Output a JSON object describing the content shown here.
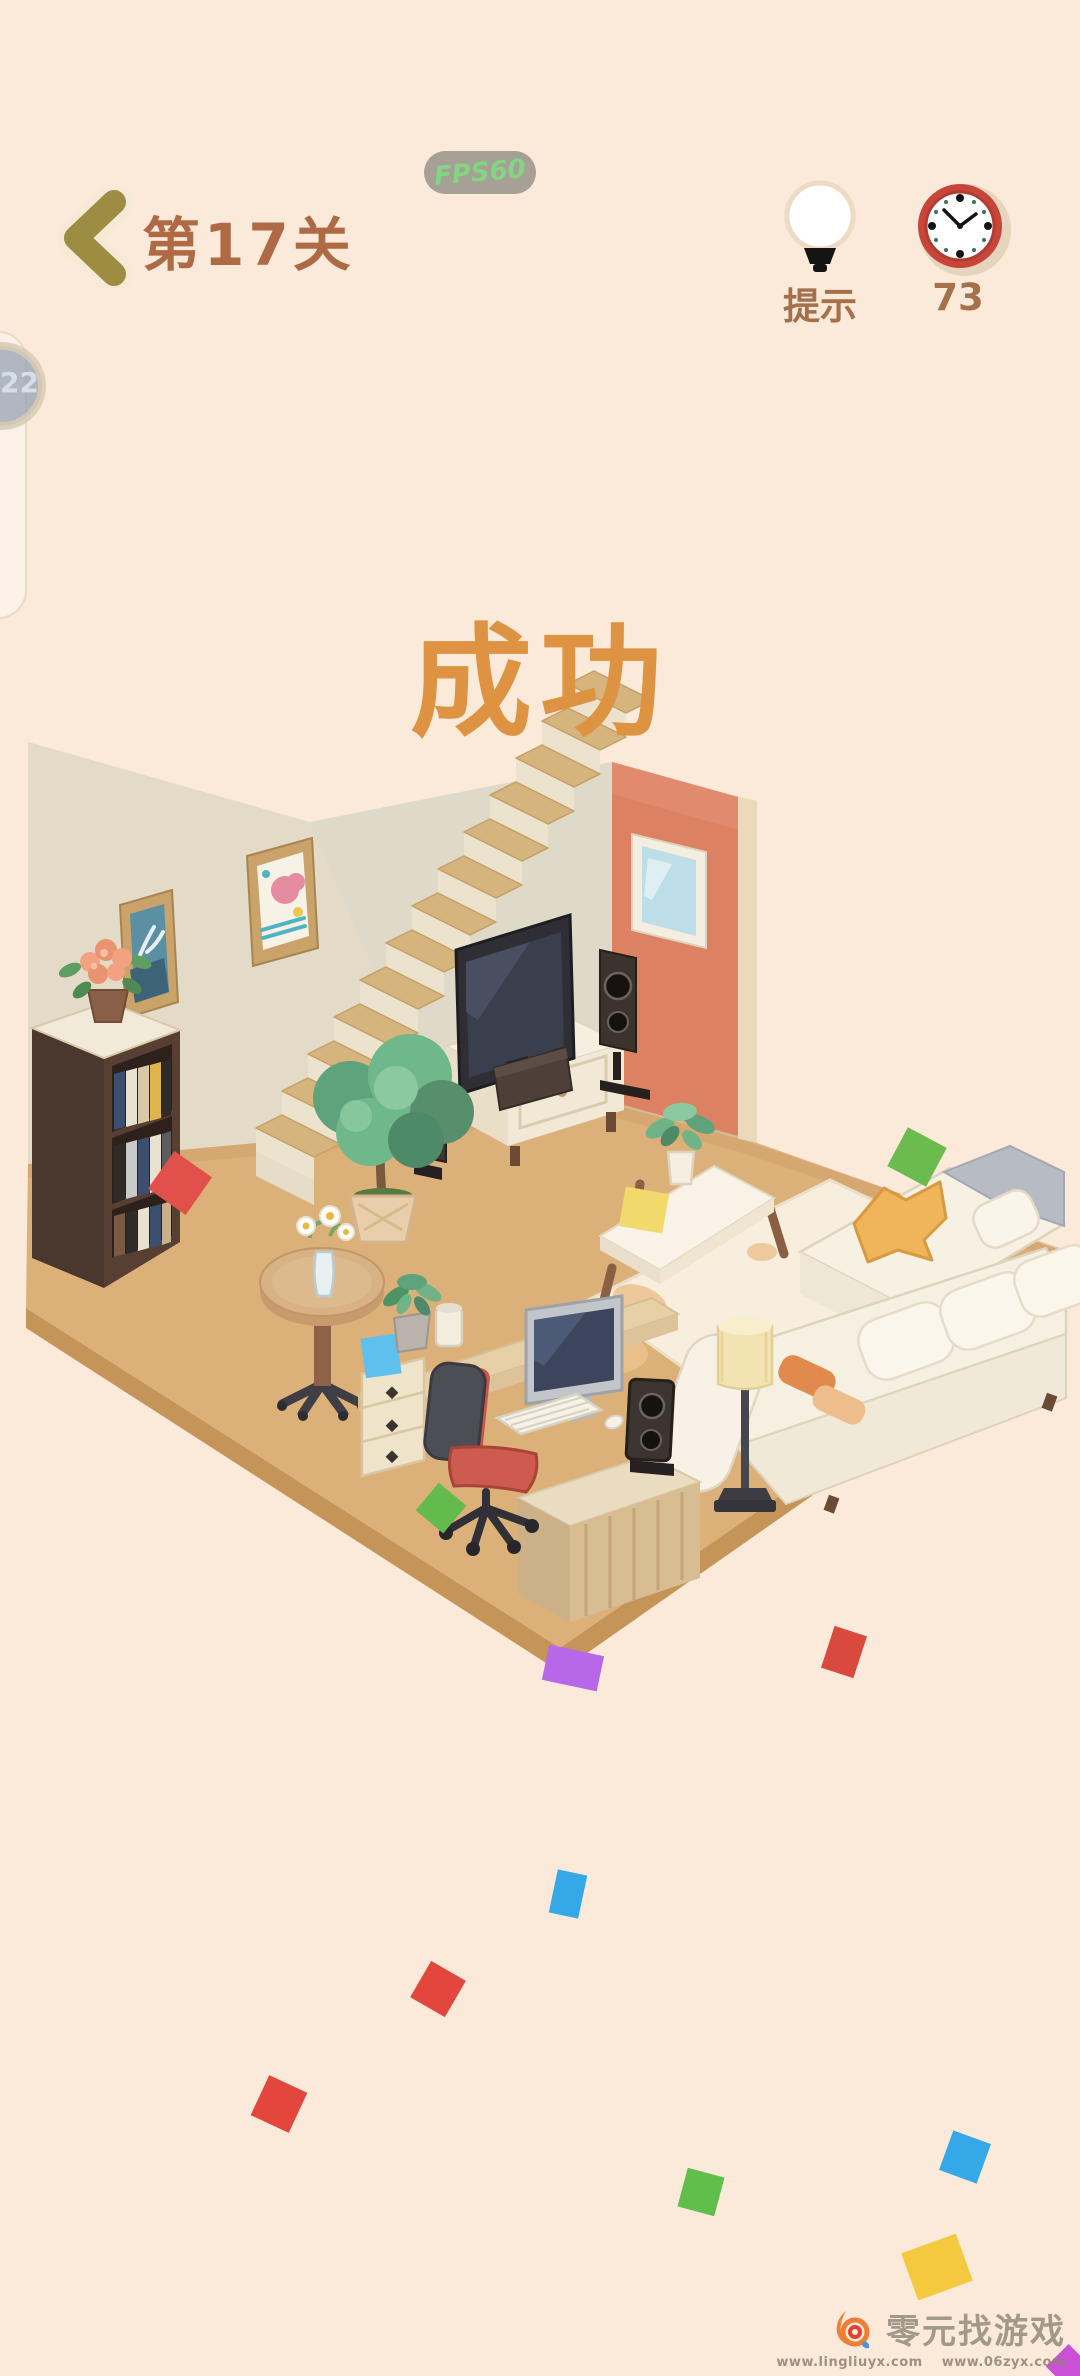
{
  "header": {
    "level_label": "第17关",
    "fps_badge": "FPS60",
    "hint_label": "提示",
    "timer_value": "73"
  },
  "floating_widget": {
    "badge_value": "22"
  },
  "overlay": {
    "success_text": "成功"
  },
  "watermark": {
    "site_name": "零元找游戏",
    "url_primary": "www.lingliuyx.com",
    "url_secondary": "www.06zyx.com"
  },
  "icons": {
    "back": "chevron-left-icon",
    "hint": "light-bulb-icon",
    "timer": "wall-clock-icon",
    "watermark_logo": "flame-logo-icon"
  },
  "colors": {
    "background": "#fbe9d9",
    "header_text": "#ae6a45",
    "success_text": "#de9343",
    "fps_text": "#82d682",
    "fps_pill_bg": "#a6a096",
    "clock_ring": "#c8453a",
    "back_chevron": "#9d8d42",
    "wall": "#e4dac8",
    "door": "#dd8163",
    "floor": "#dcb079",
    "confetti": [
      "#e2504c",
      "#6cbb4f",
      "#b668e8",
      "#35a8e8",
      "#e2463c",
      "#5fbf4a",
      "#f5c93e",
      "#cc4fd8",
      "#62bdeb",
      "#f2d96b"
    ]
  }
}
